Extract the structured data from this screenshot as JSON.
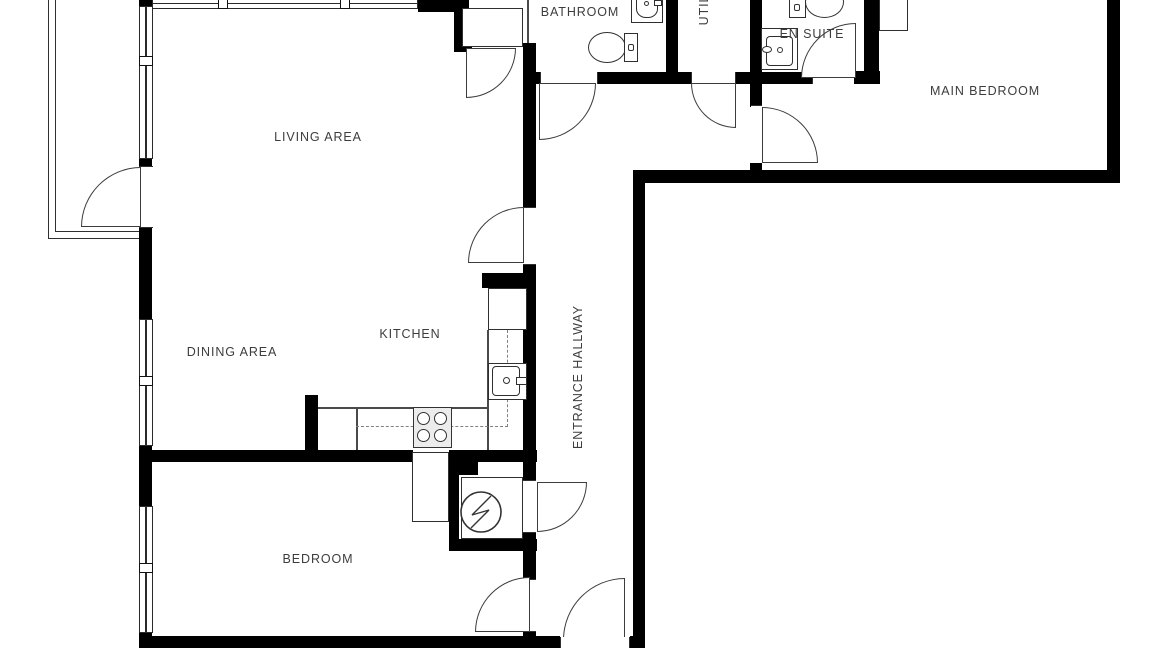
{
  "title": "Apartment floor plan",
  "colors": {
    "wall": "#000000",
    "lines": "#3c3c3c",
    "background": "#ffffff",
    "text": "#3d3d3d"
  },
  "rooms": {
    "living_area": {
      "label": "LIVING AREA"
    },
    "dining_area": {
      "label": "DINING AREA"
    },
    "kitchen": {
      "label": "KITCHEN"
    },
    "bedroom": {
      "label": "BEDROOM"
    },
    "main_bedroom": {
      "label": "MAIN BEDROOM"
    },
    "bathroom": {
      "label": "BATHROOM"
    },
    "en_suite": {
      "label": "EN SUITE"
    },
    "utility": {
      "label": "UTIL"
    },
    "entrance_hallway": {
      "label": "ENTRANCE HALLWAY"
    }
  },
  "fixtures": [
    "toilet-icon",
    "sink-icon",
    "stove-icon",
    "boiler-icon",
    "kitchen-counter",
    "kitchen-sink-icon",
    "wardrobe",
    "balcony",
    "window",
    "door-swing"
  ]
}
